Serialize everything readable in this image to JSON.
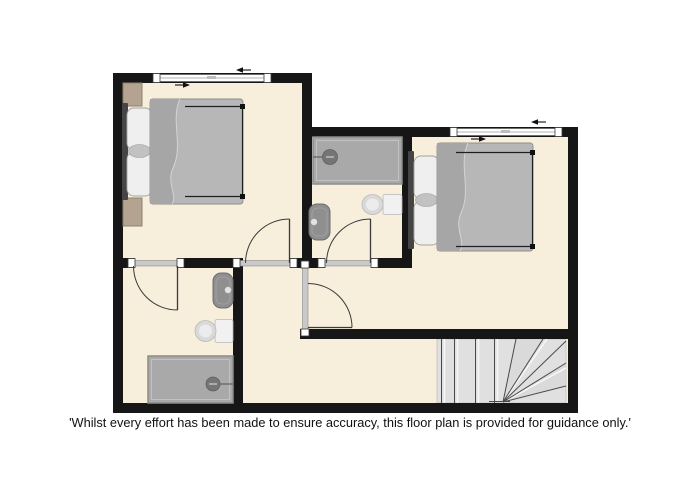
{
  "disclaimer": {
    "text": "'Whilst every effort has been made to ensure accuracy, this floor plan is provided for guidance only.'"
  },
  "colors": {
    "background": "#ffffff",
    "floor": "#f7eedc",
    "wall": "#161616",
    "window": "#ffffff",
    "threshold": "#c9c9c9",
    "door_line": "#3a3a3a",
    "duvet": "#b7b7b7",
    "duvet_fold": "#a6a6a6",
    "pillow": "#efefef",
    "headboard": "#454545",
    "bed_frame": "#1f1f1f",
    "nightstand": "#b3a390",
    "shower": "#a9a9a9",
    "shower_head": "#757575",
    "sink": "#8f8f8f",
    "toilet": "#f1f1f1",
    "toilet_bowl": "#d9d9d9",
    "stairs": "#e0e0e0",
    "stair_line": "#4a4a4a",
    "arrow": "#111111",
    "text": "#111111"
  }
}
